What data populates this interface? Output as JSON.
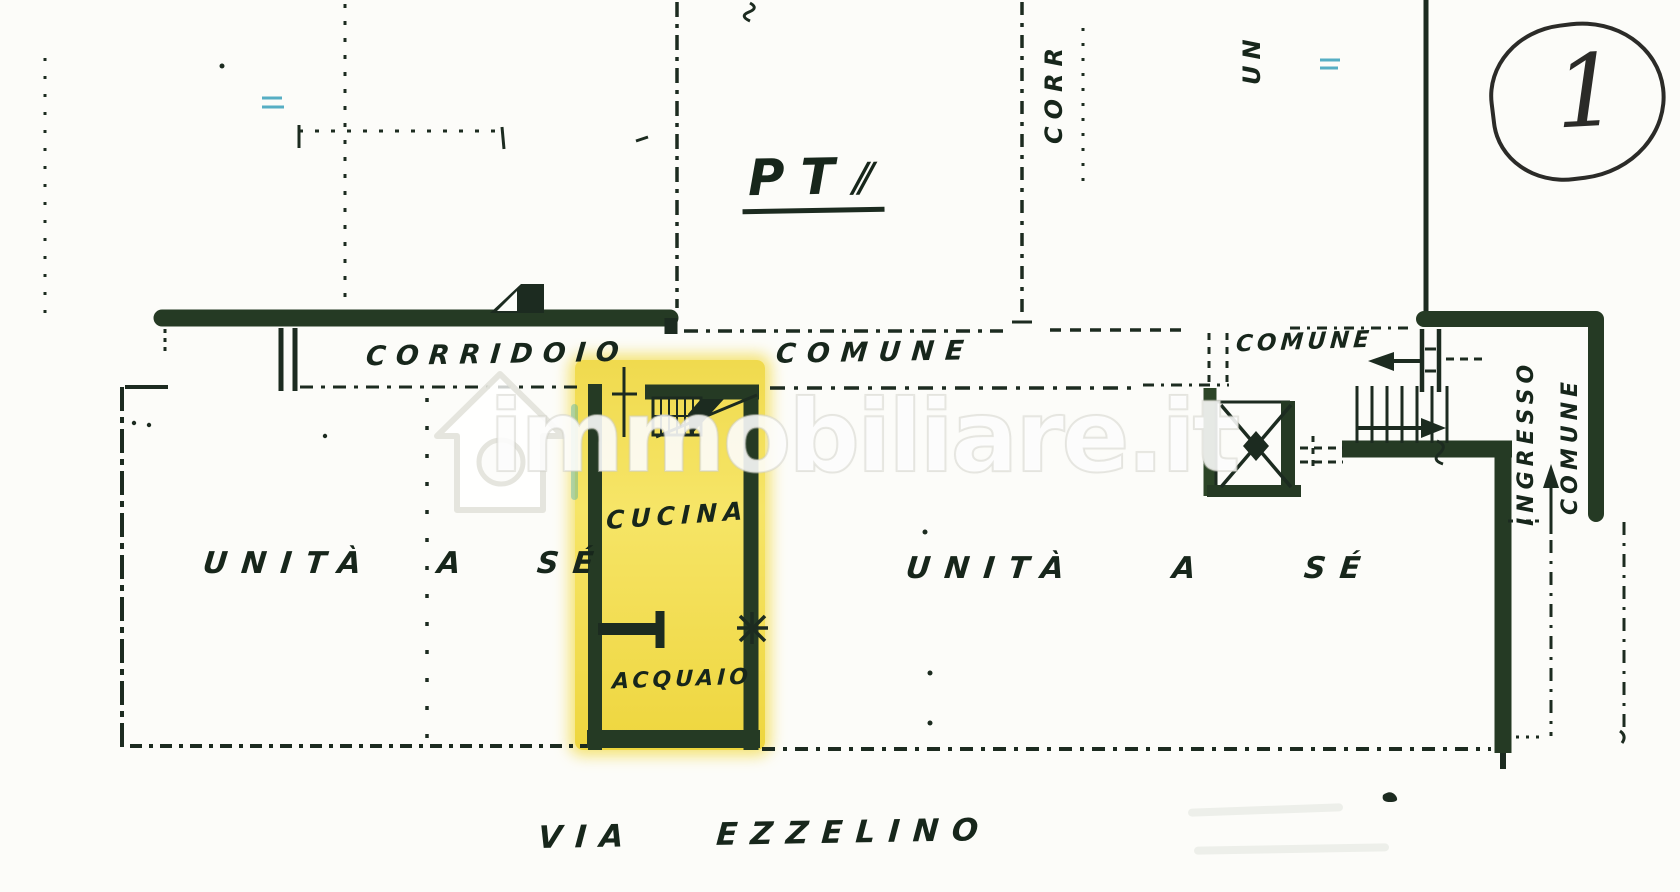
{
  "page": {
    "sheet_number": "1",
    "floor_label": "PT",
    "floor_mark": "⫽"
  },
  "corridor": {
    "label_left": "CORRIDOIO",
    "label_right": "COMUNE"
  },
  "stair_hall": {
    "label": "COMUNE"
  },
  "kitchen": {
    "room_label": "CUCINA",
    "sink_label": "ACQUAIO"
  },
  "units": {
    "left_label": "UNITÀ A SÉ",
    "right_label": "UNITÀ A SÉ"
  },
  "entrance": {
    "line1": "INGRESSO",
    "line2": "COMUNE"
  },
  "street": {
    "label": "VIA EZZELINO"
  },
  "edge_labels": {
    "top_corr": "CORR",
    "top_un": "UN"
  },
  "watermark": {
    "text": "immobiliare.it"
  },
  "colors": {
    "ink": "#1c2b20",
    "paper": "#fcfcf9",
    "highlight_yellow": "#f2dd52",
    "annotation_blue": "#56aec4",
    "watermark_white": "#ffffff"
  }
}
